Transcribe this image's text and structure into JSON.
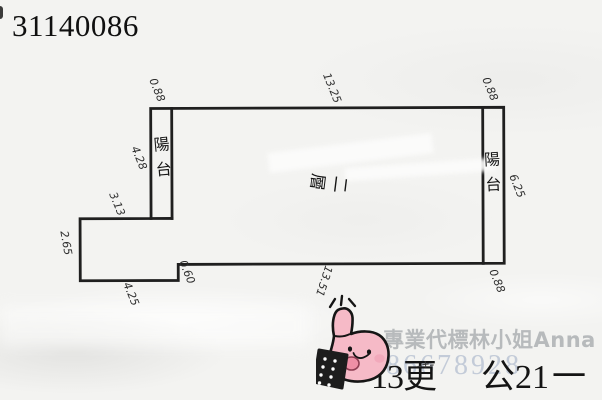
{
  "title": "31140086",
  "plan": {
    "floor_label": "二層",
    "balcony_left": "陽台",
    "balcony_right": "陽台",
    "dims": {
      "top_left_width": "0.88",
      "top_length": "13.25",
      "top_right_width": "0.88",
      "left_balcony_height": "4.28",
      "left_upper": "3.13",
      "left_lower": "2.65",
      "bottom_left": "4.25",
      "bottom_step": "0.60",
      "bottom_length": "13.51",
      "bottom_right_width": "0.88",
      "right_height": "6.25"
    }
  },
  "footer": {
    "agent_watermark": "專業代標林小姐Anna",
    "phone_watermark": "0986678928",
    "note_left": "13更",
    "note_marks": "-+-",
    "note_right": "公21",
    "note_dash": "一"
  },
  "doodle": {
    "icon": "thumbs-up-doodle"
  },
  "colors": {
    "plan_line": "#1f1f1f",
    "paper": "#f3f3f1",
    "doodle_pink": "#f6bac7",
    "doodle_tongue": "#ef8fa6",
    "doodle_cheek": "#f2a9bb",
    "watermark_gray": "#91969b",
    "phone_blue": "#9baac3"
  }
}
